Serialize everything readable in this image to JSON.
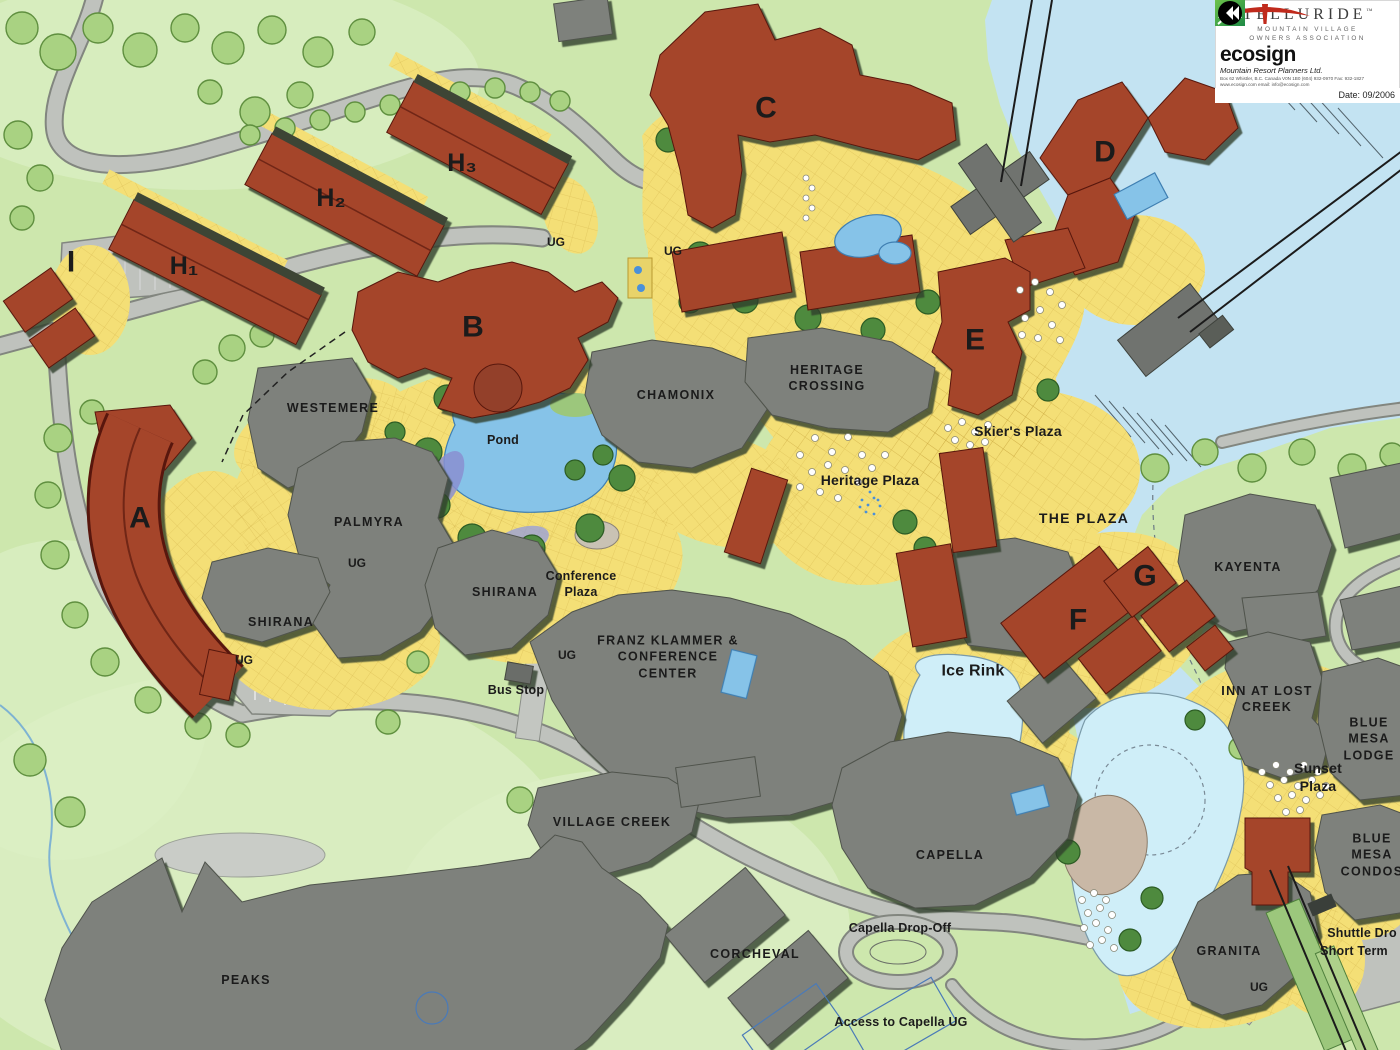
{
  "title": "Telluride Mountain Village resort master plan map",
  "legend_panel": {
    "org_name": "TELLURIDE",
    "org_trademark": "™",
    "org_subtitle_1": "MOUNTAIN VILLAGE",
    "org_subtitle_2": "OWNERS ASSOCIATION",
    "planner_name": "ecosign",
    "planner_subtitle": "Mountain Resort Planners Ltd.",
    "planner_address_line_1": "Box 62 Whistler, B.C.  Canada  V0N 1B0  (604) 932-0970  Fax: 932-1827",
    "planner_address_line_2": "www.ecosign.com        email: info@ecosign.com",
    "date_label": "Date: 09/2006"
  },
  "map": {
    "labels": [
      {
        "id": "building-i-label",
        "text": "I",
        "x": 71,
        "y": 262,
        "cls": "letter"
      },
      {
        "id": "building-h1-label",
        "text": "H₁",
        "x": 184,
        "y": 266,
        "cls": "letter sub"
      },
      {
        "id": "building-h2-label",
        "text": "H₂",
        "x": 331,
        "y": 198,
        "cls": "letter sub"
      },
      {
        "id": "building-h3-label",
        "text": "H₃",
        "x": 462,
        "y": 163,
        "cls": "letter sub"
      },
      {
        "id": "building-c-label",
        "text": "C",
        "x": 766,
        "y": 108,
        "cls": "letter"
      },
      {
        "id": "building-d-label",
        "text": "D",
        "x": 1105,
        "y": 152,
        "cls": "letter"
      },
      {
        "id": "building-b-label",
        "text": "B",
        "x": 473,
        "y": 327,
        "cls": "letter"
      },
      {
        "id": "building-e-label",
        "text": "E",
        "x": 975,
        "y": 340,
        "cls": "letter"
      },
      {
        "id": "building-a-label",
        "text": "A",
        "x": 140,
        "y": 518,
        "cls": "letter"
      },
      {
        "id": "building-f-label",
        "text": "F",
        "x": 1078,
        "y": 620,
        "cls": "letter"
      },
      {
        "id": "building-g-label",
        "text": "G",
        "x": 1145,
        "y": 576,
        "cls": "letter"
      },
      {
        "id": "westemere-label",
        "text": "WESTEMERE",
        "x": 333,
        "y": 408,
        "cls": "name"
      },
      {
        "id": "chamonix-label",
        "text": "CHAMONIX",
        "x": 676,
        "y": 395,
        "cls": "name"
      },
      {
        "id": "heritage-crossing-label",
        "text": "HERITAGE\nCROSSING",
        "x": 827,
        "y": 378,
        "cls": "name"
      },
      {
        "id": "palmyra-label",
        "text": "PALMYRA",
        "x": 369,
        "y": 522,
        "cls": "name"
      },
      {
        "id": "shirana-upper-label",
        "text": "SHIRANA",
        "x": 505,
        "y": 592,
        "cls": "name"
      },
      {
        "id": "shirana-lower-label",
        "text": "SHIRANA",
        "x": 281,
        "y": 622,
        "cls": "name"
      },
      {
        "id": "franz-klammer-label",
        "text": "FRANZ KLAMMER &\nCONFERENCE\nCENTER",
        "x": 668,
        "y": 657,
        "cls": "name"
      },
      {
        "id": "kayenta-label",
        "text": "KAYENTA",
        "x": 1248,
        "y": 567,
        "cls": "name"
      },
      {
        "id": "inn-at-lost-creek-label",
        "text": "INN AT LOST\nCREEK",
        "x": 1267,
        "y": 699,
        "cls": "name"
      },
      {
        "id": "blue-mesa-lodge-label",
        "text": "BLUE\nMESA\nLODGE",
        "x": 1369,
        "y": 739,
        "cls": "name"
      },
      {
        "id": "blue-mesa-condos-label",
        "text": "BLUE\nMESA\nCONDOS",
        "x": 1372,
        "y": 855,
        "cls": "name"
      },
      {
        "id": "village-creek-label",
        "text": "VILLAGE CREEK",
        "x": 612,
        "y": 822,
        "cls": "name"
      },
      {
        "id": "capella-label",
        "text": "CAPELLA",
        "x": 950,
        "y": 855,
        "cls": "name"
      },
      {
        "id": "corcheval-label",
        "text": "CORCHEVAL",
        "x": 755,
        "y": 954,
        "cls": "name"
      },
      {
        "id": "granita-label",
        "text": "GRANITA",
        "x": 1229,
        "y": 951,
        "cls": "name"
      },
      {
        "id": "peaks-label",
        "text": "PEAKS",
        "x": 246,
        "y": 980,
        "cls": "name"
      },
      {
        "id": "the-plaza-label",
        "text": "THE PLAZA",
        "x": 1084,
        "y": 518,
        "cls": "name mid"
      },
      {
        "id": "pond-label",
        "text": "Pond",
        "x": 503,
        "y": 440,
        "cls": "place"
      },
      {
        "id": "heritage-plaza-label",
        "text": "Heritage Plaza",
        "x": 870,
        "y": 480,
        "cls": "place mid"
      },
      {
        "id": "skiers-plaza-label",
        "text": "Skier's Plaza",
        "x": 1018,
        "y": 431,
        "cls": "place mid"
      },
      {
        "id": "conference-plaza-label",
        "text": "Conference\nPlaza",
        "x": 581,
        "y": 584,
        "cls": "place"
      },
      {
        "id": "bus-stop-label",
        "text": "Bus Stop",
        "x": 516,
        "y": 690,
        "cls": "place"
      },
      {
        "id": "ice-rink-label",
        "text": "Ice Rink",
        "x": 973,
        "y": 672,
        "cls": "place big"
      },
      {
        "id": "sunset-plaza-label",
        "text": "Sunset\nPlaza",
        "x": 1318,
        "y": 777,
        "cls": "place mid"
      },
      {
        "id": "capella-dropoff-label",
        "text": "Capella Drop-Off",
        "x": 900,
        "y": 928,
        "cls": "place"
      },
      {
        "id": "access-capella-ug-label",
        "text": "Access to Capella UG",
        "x": 901,
        "y": 1022,
        "cls": "place"
      },
      {
        "id": "shuttle-drop-label",
        "text": "Shuttle Dro",
        "x": 1362,
        "y": 933,
        "cls": "place"
      },
      {
        "id": "short-term-label",
        "text": "Short Term",
        "x": 1354,
        "y": 951,
        "cls": "place"
      },
      {
        "id": "ug-label-1",
        "text": "UG",
        "x": 556,
        "y": 243,
        "cls": "ug"
      },
      {
        "id": "ug-label-2",
        "text": "UG",
        "x": 673,
        "y": 252,
        "cls": "ug"
      },
      {
        "id": "ug-label-3",
        "text": "UG",
        "x": 357,
        "y": 564,
        "cls": "ug"
      },
      {
        "id": "ug-label-4",
        "text": "UG",
        "x": 244,
        "y": 661,
        "cls": "ug"
      },
      {
        "id": "ug-label-5",
        "text": "UG",
        "x": 567,
        "y": 656,
        "cls": "ug"
      },
      {
        "id": "ug-label-6",
        "text": "UG",
        "x": 1259,
        "y": 988,
        "cls": "ug"
      }
    ]
  },
  "colors": {
    "grass": "#cde7ad",
    "grass_light": "#dcefc4",
    "ski_run": "#c3e3f2",
    "plaza": "#f4df76",
    "plaza_grid": "#c9a63e",
    "road": "#bfc2bd",
    "road_casing": "#82867f",
    "building_existing": "#7e817c",
    "building_proposed": "#a5452c",
    "water": "#86c3e8",
    "water_light": "#cfeef8",
    "tree": "#a9d282",
    "tree_dark": "#4e8a3e",
    "cable": "#1b1b1b",
    "label": "#1b1b1b",
    "logo_red": "#c02a1c",
    "ecosign_green": "#3da23f"
  }
}
